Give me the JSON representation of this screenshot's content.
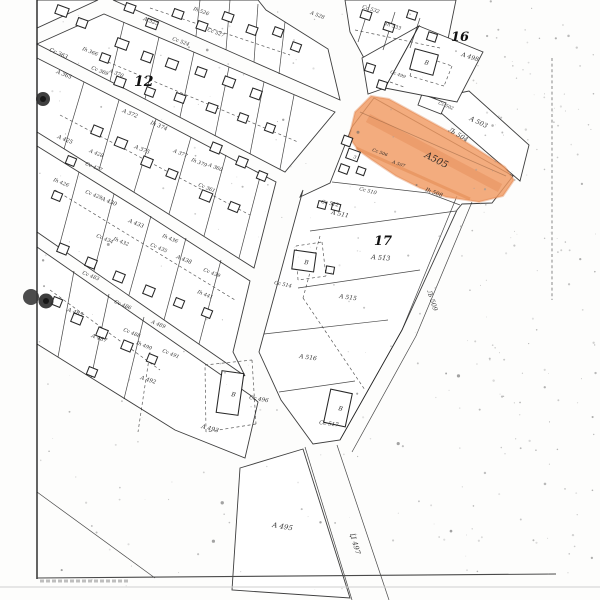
{
  "map": {
    "highlight": {
      "label": "A505",
      "fill": "#f09a62",
      "edge": "#dd7c42",
      "x": 424,
      "y": 157,
      "rot": 27,
      "fs": 9.5
    },
    "block_numbers": [
      {
        "text": "12",
        "x": 134,
        "y": 86,
        "rot": 0,
        "fs": 14
      },
      {
        "text": "16",
        "x": 451,
        "y": 41,
        "rot": 0,
        "fs": 13
      },
      {
        "text": "17",
        "x": 374,
        "y": 245,
        "rot": 0,
        "fs": 13
      }
    ],
    "road_labels": [
      {
        "text": "Љ 504",
        "x": 448,
        "y": 131,
        "rot": 31,
        "fs": 6.5
      },
      {
        "text": "Љ 509",
        "x": 427,
        "y": 291,
        "rot": 72,
        "fs": 6.5
      },
      {
        "text": "Џ 497",
        "x": 350,
        "y": 534,
        "rot": 74,
        "fs": 7
      }
    ],
    "parcel_labels": [
      {
        "text": "Cc 363",
        "x": 49,
        "y": 51,
        "rot": 24,
        "fs": 5.5
      },
      {
        "text": "A 365",
        "x": 56,
        "y": 73,
        "rot": 22,
        "fs": 5.5
      },
      {
        "text": "Ih 366",
        "x": 82,
        "y": 50,
        "rot": 22,
        "fs": 5
      },
      {
        "text": "Cc 369",
        "x": 91,
        "y": 69,
        "rot": 22,
        "fs": 5
      },
      {
        "text": "A 370",
        "x": 109,
        "y": 72,
        "rot": 22,
        "fs": 5
      },
      {
        "text": "A 525",
        "x": 143,
        "y": 20,
        "rot": 20,
        "fs": 5.5
      },
      {
        "text": "Cc 524",
        "x": 172,
        "y": 40,
        "rot": 20,
        "fs": 5
      },
      {
        "text": "Ih 526",
        "x": 193,
        "y": 10,
        "rot": 20,
        "fs": 5
      },
      {
        "text": "Cc 527",
        "x": 207,
        "y": 31,
        "rot": 20,
        "fs": 5
      },
      {
        "text": "A 528",
        "x": 310,
        "y": 14,
        "rot": 20,
        "fs": 5
      },
      {
        "text": "Cc 532",
        "x": 362,
        "y": 8,
        "rot": 18,
        "fs": 5
      },
      {
        "text": "Ih 533",
        "x": 385,
        "y": 25,
        "rot": 18,
        "fs": 5
      },
      {
        "text": "A 372",
        "x": 122,
        "y": 112,
        "rot": 22,
        "fs": 5.5
      },
      {
        "text": "Ih 374",
        "x": 150,
        "y": 124,
        "rot": 22,
        "fs": 5.5
      },
      {
        "text": "A 375",
        "x": 134,
        "y": 148,
        "rot": 22,
        "fs": 5.5
      },
      {
        "text": "A 377",
        "x": 173,
        "y": 152,
        "rot": 22,
        "fs": 5
      },
      {
        "text": "Ih 379",
        "x": 191,
        "y": 161,
        "rot": 22,
        "fs": 5
      },
      {
        "text": "A 360",
        "x": 208,
        "y": 166,
        "rot": 22,
        "fs": 5
      },
      {
        "text": "Cc 361",
        "x": 198,
        "y": 186,
        "rot": 22,
        "fs": 5
      },
      {
        "text": "A 425",
        "x": 57,
        "y": 138,
        "rot": 22,
        "fs": 5.5
      },
      {
        "text": "A 428",
        "x": 89,
        "y": 152,
        "rot": 22,
        "fs": 5
      },
      {
        "text": "Cc 427",
        "x": 85,
        "y": 165,
        "rot": 22,
        "fs": 5
      },
      {
        "text": "Ih 426",
        "x": 53,
        "y": 181,
        "rot": 22,
        "fs": 5
      },
      {
        "text": "Cc 429",
        "x": 85,
        "y": 193,
        "rot": 22,
        "fs": 5
      },
      {
        "text": "A 430",
        "x": 101,
        "y": 200,
        "rot": 22,
        "fs": 5.5
      },
      {
        "text": "A 433",
        "x": 128,
        "y": 222,
        "rot": 22,
        "fs": 5.5
      },
      {
        "text": "Ih 432",
        "x": 113,
        "y": 240,
        "rot": 22,
        "fs": 5
      },
      {
        "text": "Cc 434",
        "x": 96,
        "y": 237,
        "rot": 22,
        "fs": 5
      },
      {
        "text": "Ih 436",
        "x": 162,
        "y": 237,
        "rot": 22,
        "fs": 5
      },
      {
        "text": "Cc 435",
        "x": 150,
        "y": 246,
        "rot": 22,
        "fs": 5
      },
      {
        "text": "A 438",
        "x": 176,
        "y": 258,
        "rot": 22,
        "fs": 5.5
      },
      {
        "text": "Cc 439",
        "x": 203,
        "y": 271,
        "rot": 22,
        "fs": 5
      },
      {
        "text": "Ih 441",
        "x": 197,
        "y": 293,
        "rot": 22,
        "fs": 5
      },
      {
        "text": "Cc 483",
        "x": 82,
        "y": 274,
        "rot": 22,
        "fs": 5
      },
      {
        "text": "A 485",
        "x": 67,
        "y": 311,
        "rot": 20,
        "fs": 5.5
      },
      {
        "text": "Cc 486",
        "x": 114,
        "y": 303,
        "rot": 22,
        "fs": 5
      },
      {
        "text": "A 487",
        "x": 91,
        "y": 337,
        "rot": 20,
        "fs": 5.5
      },
      {
        "text": "Cc 488",
        "x": 123,
        "y": 331,
        "rot": 22,
        "fs": 5
      },
      {
        "text": "Ih 490",
        "x": 136,
        "y": 344,
        "rot": 22,
        "fs": 5
      },
      {
        "text": "A 489",
        "x": 151,
        "y": 323,
        "rot": 22,
        "fs": 5
      },
      {
        "text": "Cc 491",
        "x": 162,
        "y": 352,
        "rot": 22,
        "fs": 5
      },
      {
        "text": "A 492",
        "x": 140,
        "y": 379,
        "rot": 18,
        "fs": 5.5
      },
      {
        "text": "A 493",
        "x": 201,
        "y": 428,
        "rot": 15,
        "fs": 6
      },
      {
        "text": "Cc 496",
        "x": 249,
        "y": 399,
        "rot": 10,
        "fs": 5.5
      },
      {
        "text": "Cc 517",
        "x": 319,
        "y": 424,
        "rot": 8,
        "fs": 5.5
      },
      {
        "text": "A 516",
        "x": 299,
        "y": 358,
        "rot": 8,
        "fs": 6
      },
      {
        "text": "A 515",
        "x": 339,
        "y": 298,
        "rot": 8,
        "fs": 6
      },
      {
        "text": "A 511",
        "x": 331,
        "y": 214,
        "rot": 12,
        "fs": 6
      },
      {
        "text": "Cc 512",
        "x": 321,
        "y": 203,
        "rot": 12,
        "fs": 5
      },
      {
        "text": "Cc 510",
        "x": 359,
        "y": 190,
        "rot": 15,
        "fs": 5
      },
      {
        "text": "Ih 508",
        "x": 425,
        "y": 191,
        "rot": 20,
        "fs": 5.5
      },
      {
        "text": "Cc 506",
        "x": 372,
        "y": 151,
        "rot": 20,
        "fs": 4.5
      },
      {
        "text": "A 507",
        "x": 392,
        "y": 163,
        "rot": 20,
        "fs": 4.5
      },
      {
        "text": "Cc 499",
        "x": 390,
        "y": 73,
        "rot": 20,
        "fs": 4.5
      },
      {
        "text": "Cc 502",
        "x": 438,
        "y": 104,
        "rot": 22,
        "fs": 4.5
      },
      {
        "text": "A 503",
        "x": 469,
        "y": 120,
        "rot": 25,
        "fs": 6.5
      },
      {
        "text": "A 498",
        "x": 461,
        "y": 56,
        "rot": 18,
        "fs": 6
      },
      {
        "text": "A 513",
        "x": 371,
        "y": 259,
        "rot": 5,
        "fs": 6.5
      },
      {
        "text": "Cc 514",
        "x": 274,
        "y": 284,
        "rot": 12,
        "fs": 5
      },
      {
        "text": "A 495",
        "x": 272,
        "y": 527,
        "rot": 10,
        "fs": 7
      }
    ],
    "building_marks": [
      {
        "text": "B",
        "x": 424,
        "y": 64,
        "rot": 15,
        "fs": 6
      },
      {
        "text": "B",
        "x": 231,
        "y": 396,
        "rot": 10,
        "fs": 6
      },
      {
        "text": "B",
        "x": 338,
        "y": 410,
        "rot": 12,
        "fs": 6
      },
      {
        "text": "B",
        "x": 304,
        "y": 264,
        "rot": 8,
        "fs": 6
      },
      {
        "text": "3",
        "x": 353,
        "y": 158,
        "rot": 20,
        "fs": 4.5
      }
    ]
  }
}
